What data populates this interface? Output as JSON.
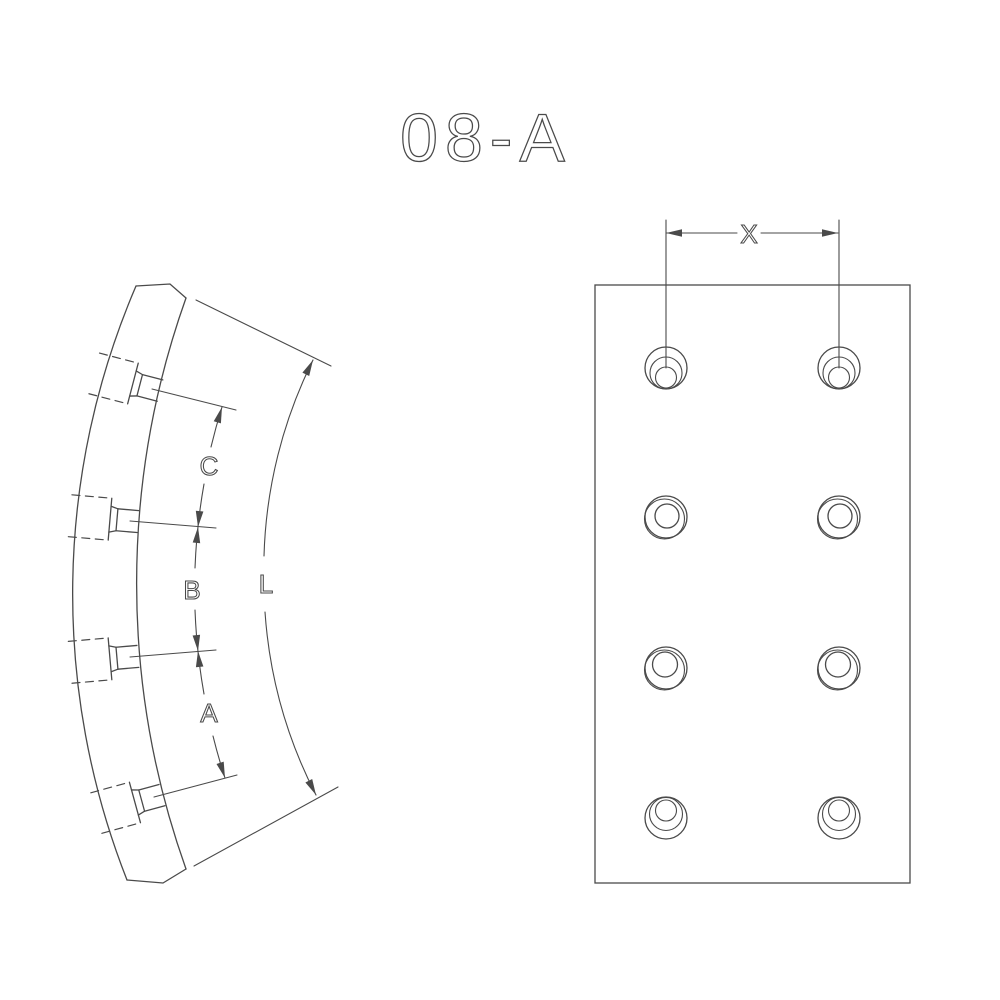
{
  "title": "08-A",
  "colors": {
    "line": "#4a4a4a",
    "background": "#ffffff"
  },
  "side_view": {
    "hole_count": 4,
    "dimensions": {
      "spacing_top": "C",
      "spacing_middle": "B",
      "spacing_bottom": "A",
      "arc_length": "L"
    }
  },
  "plan_view": {
    "hole_rows": 4,
    "hole_columns": 2,
    "dimensions": {
      "column_spacing": "X"
    }
  }
}
